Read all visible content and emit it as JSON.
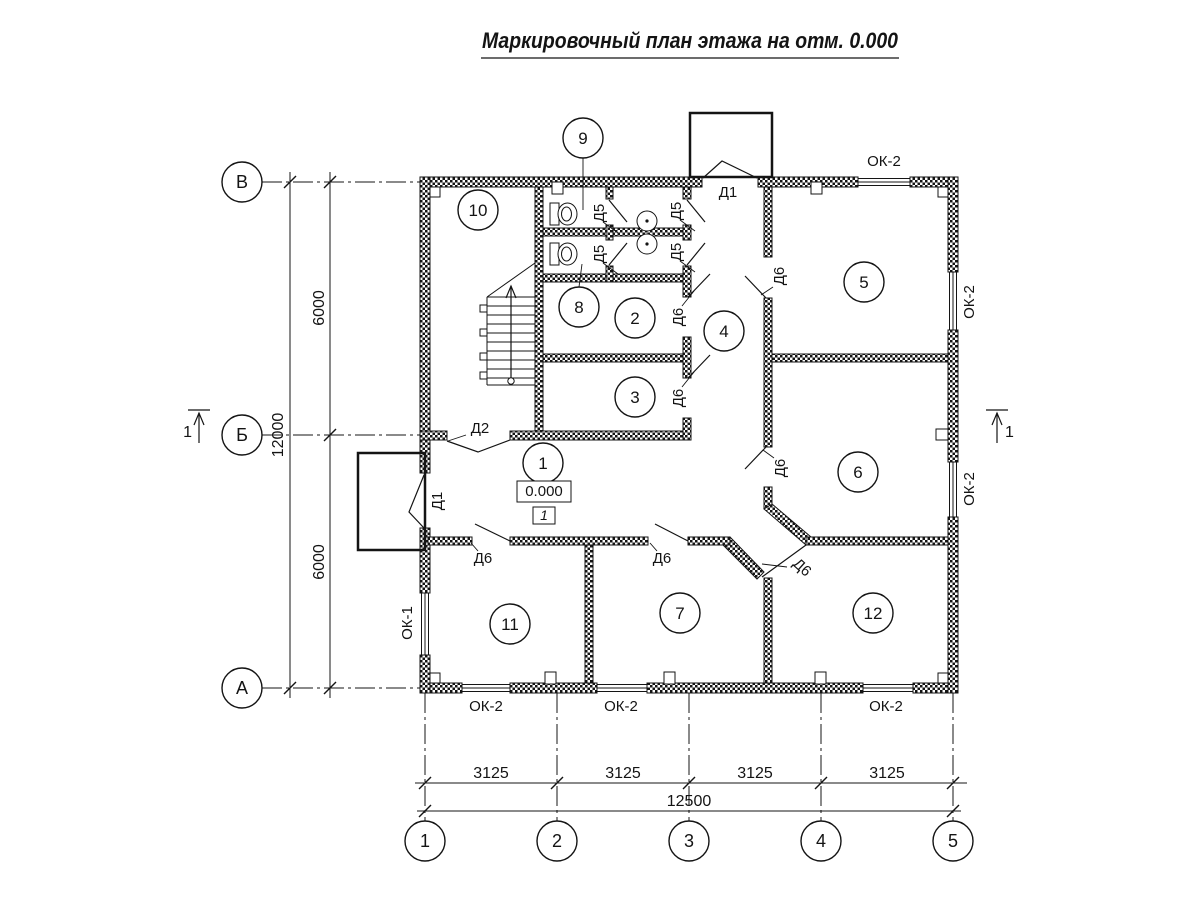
{
  "title": "Маркировочный план этажа на отм. 0.000",
  "axes": {
    "rows": [
      "В",
      "Б",
      "А"
    ],
    "cols": [
      "1",
      "2",
      "3",
      "4",
      "5"
    ]
  },
  "rooms": [
    "1",
    "2",
    "3",
    "4",
    "5",
    "6",
    "7",
    "8",
    "9",
    "10",
    "11",
    "12"
  ],
  "doors": {
    "d1": "Д1",
    "d2": "Д2",
    "d5": "Д5",
    "d6": "Д6"
  },
  "windows": {
    "ok1": "ОК-1",
    "ok2": "ОК-2"
  },
  "dims": {
    "left_segments": [
      "6000",
      "6000"
    ],
    "left_total": "12000",
    "bottom_segments": [
      "3125",
      "3125",
      "3125",
      "3125"
    ],
    "bottom_total": "12500"
  },
  "elevation": {
    "value": "0.000",
    "floor_mark": "1"
  },
  "section": {
    "label": "1"
  },
  "colors": {
    "line": "#141414",
    "background": "#ffffff"
  }
}
